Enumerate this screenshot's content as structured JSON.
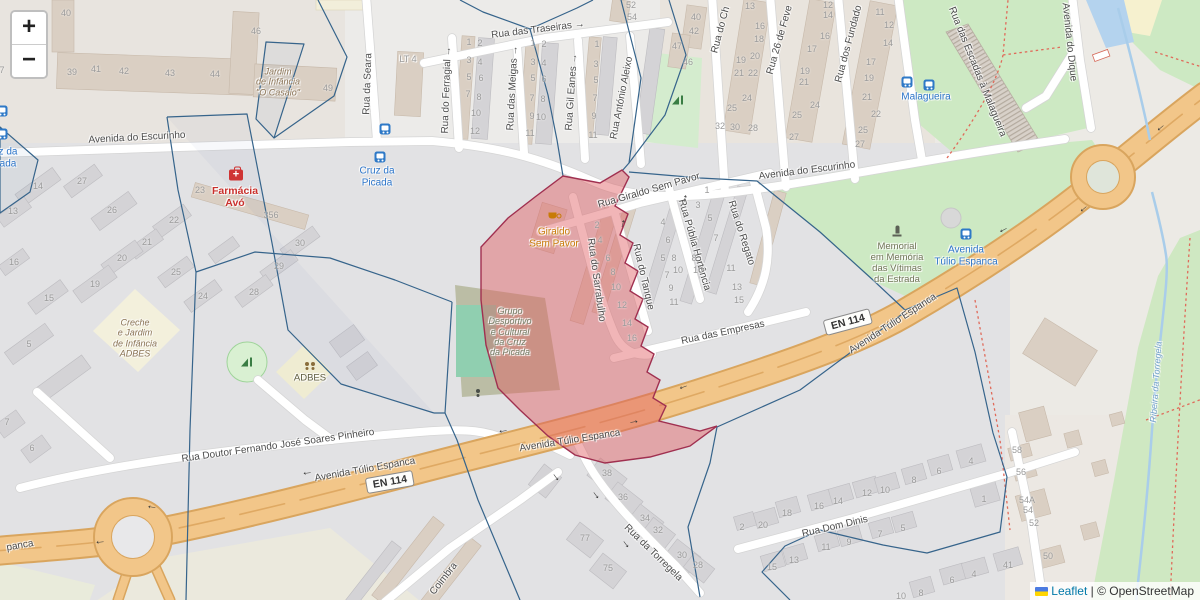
{
  "controls": {
    "zoom_in": "+",
    "zoom_out": "−"
  },
  "attribution": {
    "leaflet_link": "Leaflet",
    "separator": " | ",
    "copyright": "© OpenStreetMap"
  },
  "colors": {
    "red_overlay_fill": "#e15a5f",
    "red_overlay_stroke": "#a03050",
    "boundary": "#36648b",
    "trunk_road": "#f2c689",
    "trunk_casing": "#d9a55e",
    "park": "#cde9c3",
    "water": "#a9cdea",
    "transit_blue": "#2b74c9",
    "pharmacy_red": "#c9302c",
    "cafe_orange": "#c87b06"
  },
  "streets": [
    {
      "t": "Avenida do Escurinho",
      "x": 137,
      "y": 138,
      "r": -3
    },
    {
      "t": "Avenida do Escurinho",
      "x": 807,
      "y": 171,
      "r": -7
    },
    {
      "t": "Rua da Seara",
      "x": 368,
      "y": 84,
      "r": -88
    },
    {
      "t": "LT 4",
      "x": 408,
      "y": 59,
      "r": 0,
      "s": 9,
      "dim": 1
    },
    {
      "t": "Rua das Traseiras →",
      "x": 538,
      "y": 30,
      "r": -7
    },
    {
      "t": "Rua do Ferragial →",
      "x": 447,
      "y": 90,
      "r": -88
    },
    {
      "t": "Rua das Meigas →",
      "x": 513,
      "y": 88,
      "r": -87
    },
    {
      "t": "Rua Gil Eanes →",
      "x": 572,
      "y": 92,
      "r": -86
    },
    {
      "t": "Rua António Aleixo",
      "x": 622,
      "y": 98,
      "r": -79
    },
    {
      "t": "Rua do Ch",
      "x": 721,
      "y": 30,
      "r": -75
    },
    {
      "t": "Rua 26 de Feve",
      "x": 780,
      "y": 40,
      "r": -74
    },
    {
      "t": "Rua dos Fundado",
      "x": 849,
      "y": 44,
      "r": -75
    },
    {
      "t": "Rua das Escadas à Malagueira",
      "x": 977,
      "y": 72,
      "r": 68
    },
    {
      "t": "Avenida do Dique",
      "x": 1069,
      "y": 42,
      "r": 84
    },
    {
      "t": "Rua Giraldo Sem Pavor",
      "x": 649,
      "y": 191,
      "r": -16
    },
    {
      "t": "Rua do Sarrabulho",
      "x": 596,
      "y": 280,
      "r": 82
    },
    {
      "t": "Rua do Tanque",
      "x": 643,
      "y": 277,
      "r": 77
    },
    {
      "t": "Rua Públia Hortência",
      "x": 694,
      "y": 245,
      "r": 74
    },
    {
      "t": "Rua do Regato",
      "x": 741,
      "y": 233,
      "r": 72
    },
    {
      "t": "Rua das Empresas",
      "x": 723,
      "y": 333,
      "r": -12
    },
    {
      "t": "Rua Doutor Fernando José Soares Pinheiro",
      "x": 278,
      "y": 446,
      "r": -8
    },
    {
      "t": "Avenida Túlio Espanca",
      "x": 365,
      "y": 470,
      "r": -10
    },
    {
      "t": "Avenida Túlio Espanca",
      "x": 570,
      "y": 441,
      "r": -9
    },
    {
      "t": "Avenida Túlio Espanca",
      "x": 893,
      "y": 324,
      "r": -33
    },
    {
      "t": "panca",
      "x": 20,
      "y": 546,
      "r": -10
    },
    {
      "t": "Rua da Torregela",
      "x": 653,
      "y": 553,
      "r": 44
    },
    {
      "t": "Rua Dom Dinis",
      "x": 835,
      "y": 527,
      "r": -13
    },
    {
      "t": "Coimbra",
      "x": 444,
      "y": 579,
      "r": -52
    }
  ],
  "pois": [
    {
      "name": "kindergarten-casaio-label",
      "lines": [
        "Jardim",
        "de Infância",
        "\"O Casaio\""
      ],
      "x": 278,
      "y": 82,
      "c": "kindergarten",
      "fs": 9,
      "i": 1
    },
    {
      "name": "creche-adbes-label",
      "lines": [
        "Creche",
        "e Jardim",
        "de Infância",
        "ADBES"
      ],
      "x": 135,
      "y": 338,
      "c": "kindergarten",
      "fs": 9,
      "i": 1
    },
    {
      "name": "adbes-label",
      "lines": [
        "ADBES"
      ],
      "x": 310,
      "y": 379,
      "c": "community",
      "fs": 9.5
    },
    {
      "name": "farmacia-avo-label",
      "lines": [
        "Farmácia",
        "Avó"
      ],
      "x": 235,
      "y": 197,
      "c": "pharmacy",
      "fs": 10.5
    },
    {
      "name": "giraldo-sem-pavor-label",
      "lines": [
        "Giraldo",
        "Sem Pavor"
      ],
      "x": 554,
      "y": 238,
      "c": "cafe",
      "fs": 10
    },
    {
      "name": "grupo-desportivo-label",
      "lines": [
        "Grupo",
        "Desportivo",
        "e Cultural",
        "da Cruz",
        "da Picada"
      ],
      "x": 510,
      "y": 332,
      "c": "sports",
      "fs": 9,
      "i": 1
    },
    {
      "name": "memorial-vitimas-label",
      "lines": [
        "Memorial",
        "em Memória",
        "das Vítimas",
        "da Estrada"
      ],
      "x": 897,
      "y": 264,
      "c": "memorial",
      "fs": 9.5
    },
    {
      "name": "busstop-cruz-picada-left-label",
      "lines": [
        "z da",
        "ada"
      ],
      "x": 8,
      "y": 158,
      "c": "transit",
      "fs": 10
    },
    {
      "name": "busstop-cruz-picada-label",
      "lines": [
        "Cruz da",
        "Picada"
      ],
      "x": 377,
      "y": 177,
      "c": "transit",
      "fs": 10
    },
    {
      "name": "busstop-malagueira-label",
      "lines": [
        "Malagueira"
      ],
      "x": 926,
      "y": 97,
      "c": "transit",
      "fs": 10
    },
    {
      "name": "busstop-avenida-tulio-label",
      "lines": [
        "Avenida",
        "Túlio Espanca"
      ],
      "x": 966,
      "y": 256,
      "c": "transit",
      "fs": 10
    },
    {
      "name": "ribeira-torregela-label",
      "lines": [
        "Ribeira da Torregela"
      ],
      "x": 1156,
      "y": 382,
      "c": "water",
      "fs": 9,
      "i": 1,
      "r": -86
    }
  ],
  "road_refs": [
    {
      "t": "EN 114",
      "x": 390,
      "y": 482,
      "r": -10
    },
    {
      "t": "EN 114",
      "x": 848,
      "y": 322,
      "r": -15
    }
  ],
  "house_numbers": [
    [
      "40",
      66,
      13
    ],
    [
      "39",
      72,
      72
    ],
    [
      "41",
      96,
      69
    ],
    [
      "42",
      124,
      71
    ],
    [
      "43",
      170,
      73
    ],
    [
      "44",
      215,
      74
    ],
    [
      "46",
      256,
      31
    ],
    [
      "49",
      328,
      88
    ],
    [
      "7",
      2,
      70
    ],
    [
      "1",
      469,
      42
    ],
    [
      "2",
      480,
      43
    ],
    [
      "3",
      469,
      60
    ],
    [
      "4",
      480,
      62
    ],
    [
      "5",
      469,
      77
    ],
    [
      "6",
      481,
      78
    ],
    [
      "7",
      468,
      94
    ],
    [
      "8",
      479,
      97
    ],
    [
      "10",
      476,
      113
    ],
    [
      "12",
      475,
      131
    ],
    [
      "1",
      533,
      43
    ],
    [
      "2",
      544,
      44
    ],
    [
      "3",
      533,
      62
    ],
    [
      "4",
      544,
      63
    ],
    [
      "5",
      533,
      78
    ],
    [
      "6",
      544,
      79
    ],
    [
      "7",
      532,
      98
    ],
    [
      "8",
      543,
      99
    ],
    [
      "9",
      532,
      116
    ],
    [
      "10",
      541,
      117
    ],
    [
      "11",
      530,
      133
    ],
    [
      "1",
      597,
      44
    ],
    [
      "3",
      596,
      64
    ],
    [
      "5",
      596,
      80
    ],
    [
      "7",
      595,
      98
    ],
    [
      "9",
      594,
      116
    ],
    [
      "11",
      593,
      135
    ],
    [
      "52",
      631,
      5
    ],
    [
      "54",
      632,
      17
    ],
    [
      "40",
      696,
      17
    ],
    [
      "42",
      694,
      31
    ],
    [
      "47",
      677,
      46
    ],
    [
      "46",
      688,
      62
    ],
    [
      "13",
      750,
      6
    ],
    [
      "16",
      760,
      26
    ],
    [
      "18",
      759,
      39
    ],
    [
      "19",
      741,
      60
    ],
    [
      "20",
      755,
      56
    ],
    [
      "21",
      739,
      73
    ],
    [
      "22",
      753,
      73
    ],
    [
      "24",
      747,
      98
    ],
    [
      "25",
      732,
      108
    ],
    [
      "32",
      720,
      126
    ],
    [
      "30",
      735,
      127
    ],
    [
      "28",
      753,
      128
    ],
    [
      "12",
      828,
      5
    ],
    [
      "14",
      828,
      15
    ],
    [
      "16",
      825,
      36
    ],
    [
      "17",
      812,
      49
    ],
    [
      "19",
      805,
      71
    ],
    [
      "21",
      804,
      82
    ],
    [
      "24",
      815,
      105
    ],
    [
      "25",
      797,
      115
    ],
    [
      "27",
      794,
      137
    ],
    [
      "11",
      880,
      12
    ],
    [
      "12",
      889,
      25
    ],
    [
      "14",
      888,
      43
    ],
    [
      "17",
      871,
      62
    ],
    [
      "19",
      869,
      78
    ],
    [
      "21",
      867,
      97
    ],
    [
      "22",
      876,
      114
    ],
    [
      "25",
      863,
      130
    ],
    [
      "27",
      860,
      144
    ],
    [
      "14",
      38,
      186
    ],
    [
      "27",
      82,
      181
    ],
    [
      "13",
      13,
      211
    ],
    [
      "26",
      112,
      210
    ],
    [
      "23",
      200,
      190
    ],
    [
      "356",
      271,
      215
    ],
    [
      "22",
      174,
      220
    ],
    [
      "21",
      147,
      242
    ],
    [
      "30",
      300,
      243
    ],
    [
      "20",
      122,
      258
    ],
    [
      "16",
      14,
      262
    ],
    [
      "19",
      95,
      284
    ],
    [
      "15",
      49,
      298
    ],
    [
      "25",
      176,
      272
    ],
    [
      "24",
      203,
      296
    ],
    [
      "29",
      279,
      266
    ],
    [
      "28",
      254,
      292
    ],
    [
      "5",
      29,
      344
    ],
    [
      "2",
      597,
      225
    ],
    [
      "4",
      600,
      240
    ],
    [
      "6",
      608,
      258
    ],
    [
      "8",
      613,
      272
    ],
    [
      "10",
      616,
      287
    ],
    [
      "12",
      622,
      305
    ],
    [
      "14",
      627,
      323
    ],
    [
      "16",
      632,
      338
    ],
    [
      "4",
      663,
      222
    ],
    [
      "6",
      668,
      240
    ],
    [
      "5",
      663,
      258
    ],
    [
      "8",
      674,
      258
    ],
    [
      "10",
      678,
      270
    ],
    [
      "7",
      667,
      275
    ],
    [
      "9",
      671,
      288
    ],
    [
      "11",
      674,
      302
    ],
    [
      "8",
      694,
      258
    ],
    [
      "10",
      698,
      270
    ],
    [
      "1",
      707,
      190
    ],
    [
      "3",
      698,
      205
    ],
    [
      "5",
      710,
      218
    ],
    [
      "7",
      716,
      238
    ],
    [
      "11",
      731,
      268
    ],
    [
      "13",
      737,
      287
    ],
    [
      "15",
      739,
      300
    ],
    [
      "7",
      7,
      422
    ],
    [
      "6",
      32,
      448
    ],
    [
      "38",
      607,
      473
    ],
    [
      "36",
      623,
      497
    ],
    [
      "34",
      645,
      518
    ],
    [
      "32",
      658,
      530
    ],
    [
      "30",
      682,
      555
    ],
    [
      "28",
      698,
      565
    ],
    [
      "77",
      585,
      538
    ],
    [
      "75",
      608,
      568
    ],
    [
      "58",
      1017,
      450
    ],
    [
      "56",
      1021,
      472
    ],
    [
      "54A",
      1027,
      500
    ],
    [
      "54",
      1028,
      510
    ],
    [
      "52",
      1034,
      523
    ],
    [
      "50",
      1048,
      556
    ],
    [
      "41",
      1008,
      565
    ],
    [
      "1",
      984,
      499
    ],
    [
      "4",
      971,
      461
    ],
    [
      "6",
      939,
      471
    ],
    [
      "8",
      914,
      480
    ],
    [
      "12",
      867,
      493
    ],
    [
      "10",
      885,
      490
    ],
    [
      "16",
      819,
      506
    ],
    [
      "14",
      838,
      501
    ],
    [
      "18",
      787,
      513
    ],
    [
      "20",
      763,
      525
    ],
    [
      "2",
      742,
      527
    ],
    [
      "15",
      772,
      567
    ],
    [
      "13",
      794,
      560
    ],
    [
      "11",
      826,
      547
    ],
    [
      "9",
      849,
      542
    ],
    [
      "7",
      880,
      534
    ],
    [
      "5",
      903,
      528
    ],
    [
      "6",
      952,
      580
    ],
    [
      "4",
      974,
      574
    ],
    [
      "8",
      921,
      593
    ],
    [
      "10",
      901,
      596
    ]
  ],
  "icons": [
    {
      "n": "bus-stop-icon",
      "x": 2,
      "y": 111
    },
    {
      "n": "bus-stop-icon",
      "x": 2,
      "y": 134
    },
    {
      "n": "bus-stop-icon",
      "x": 385,
      "y": 129
    },
    {
      "n": "bus-stop-icon",
      "x": 380,
      "y": 157
    },
    {
      "n": "bus-stop-icon",
      "x": 907,
      "y": 82
    },
    {
      "n": "bus-stop-icon",
      "x": 929,
      "y": 85
    },
    {
      "n": "bus-stop-icon",
      "x": 966,
      "y": 234
    },
    {
      "n": "pharmacy-icon",
      "x": 236,
      "y": 175
    },
    {
      "n": "cafe-icon",
      "x": 554,
      "y": 216
    },
    {
      "n": "memorial-icon",
      "x": 897,
      "y": 231
    },
    {
      "n": "playground-icon",
      "x": 678,
      "y": 100
    },
    {
      "n": "playground-icon",
      "x": 247,
      "y": 362
    },
    {
      "n": "community-icon",
      "x": 310,
      "y": 367
    },
    {
      "n": "sports-icon",
      "x": 478,
      "y": 394
    },
    {
      "n": "oneway-arrow",
      "x": 152,
      "y": 506,
      "r": 8
    },
    {
      "n": "oneway-arrow",
      "x": 307,
      "y": 472,
      "r": -8
    },
    {
      "n": "oneway-arrow",
      "x": 503,
      "y": 430,
      "r": -9
    },
    {
      "n": "oneway-arrow",
      "x": 634,
      "y": 423,
      "r": 171
    },
    {
      "n": "oneway-arrow",
      "x": 683,
      "y": 386,
      "r": -20
    },
    {
      "n": "oneway-arrow",
      "x": 1003,
      "y": 229,
      "r": -27
    },
    {
      "n": "oneway-arrow",
      "x": 1083,
      "y": 208,
      "r": -40
    },
    {
      "n": "oneway-arrow",
      "x": 1160,
      "y": 127,
      "r": -40
    },
    {
      "n": "oneway-arrow",
      "x": 100,
      "y": 541,
      "r": -5
    },
    {
      "n": "oneway-arrow",
      "x": 555,
      "y": 478,
      "r": -127
    },
    {
      "n": "oneway-arrow",
      "x": 595,
      "y": 496,
      "r": -127
    },
    {
      "n": "oneway-arrow",
      "x": 625,
      "y": 545,
      "r": -127
    },
    {
      "n": "oneway-arrow",
      "x": 624,
      "y": 224,
      "r": 105
    },
    {
      "n": "oneway-arrow",
      "x": 686,
      "y": 199,
      "r": 105
    }
  ]
}
